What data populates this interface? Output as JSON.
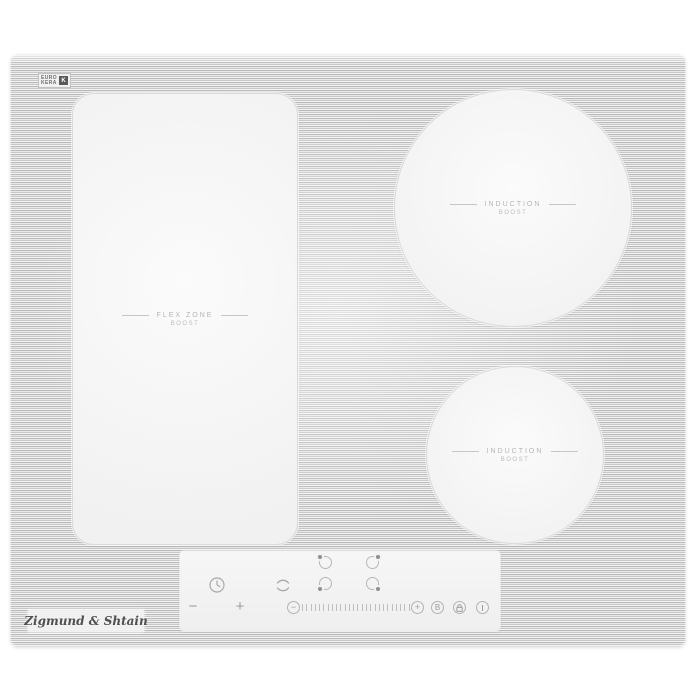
{
  "product": {
    "brand_label": "Zigmund & Shtain",
    "badge": {
      "line1": "EURO",
      "line2": "KERA",
      "mark": "K"
    }
  },
  "zones": {
    "flex": {
      "line1": "FLEX ZONE",
      "line2": "BOOST"
    },
    "induction_top": {
      "line1": "INDUCTION",
      "line2": "BOOST"
    },
    "induction_bottom": {
      "line1": "INDUCTION",
      "line2": "BOOST"
    }
  },
  "control_panel": {
    "timer_minus": "−",
    "timer_plus": "+",
    "slider_minus": "−",
    "slider_plus": "+",
    "boost_key": "B",
    "slider_tick_count": 26
  },
  "colors": {
    "background": "#ffffff",
    "stripe_dark": "#b9b9b9",
    "stripe_light": "#f4f4f4",
    "zone_surface": "#f6f6f6",
    "panel_surface": "#f3f3f3",
    "zone_label_text": "#b5b5b5",
    "icon_stroke": "#a9a9a9",
    "brand_text": "#4f4f4f"
  }
}
